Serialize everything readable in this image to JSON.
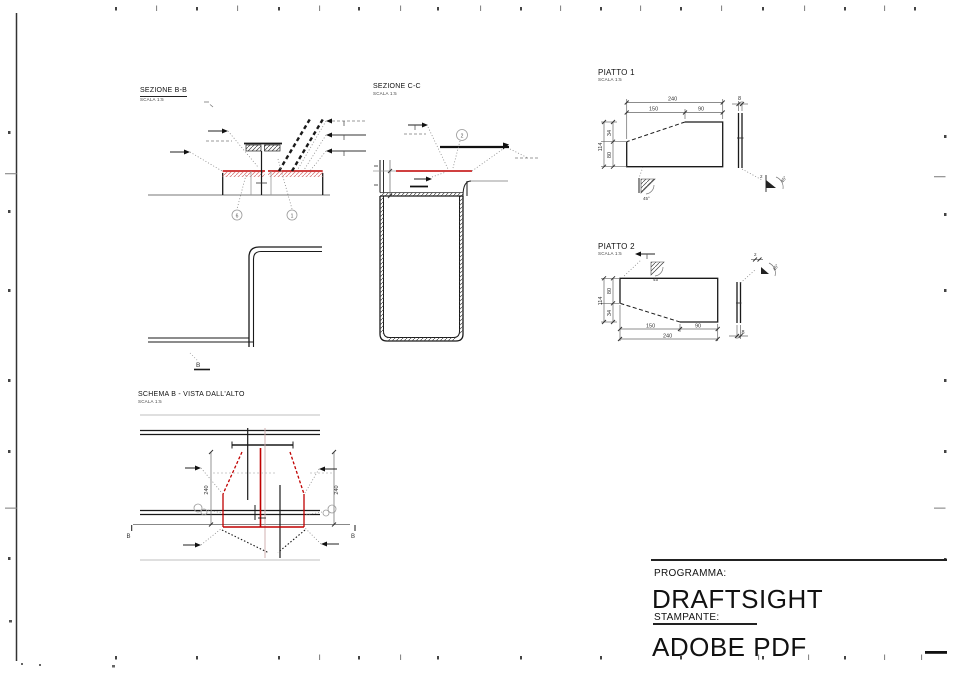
{
  "sheet": {
    "background": "#ffffff",
    "frame_color": "#333333"
  },
  "colors": {
    "red": "#c00000",
    "line": "#1a1a1a",
    "dim": "#555555",
    "construction": "#999999"
  },
  "views": {
    "sezione_bb": {
      "title": "SEZIONE B-B",
      "scale": "SCALA 1:5",
      "balloon_left": "6",
      "balloon_right": "1",
      "section_marker": "B"
    },
    "sezione_cc": {
      "title": "SEZIONE C-C",
      "scale": "SCALA 1:5",
      "balloon": "2"
    },
    "piatto1": {
      "title": "PIATTO 1",
      "scale": "SCALA 1:5",
      "dims": {
        "total": "240",
        "seg_left": "150",
        "seg_right": "90",
        "thickness": "8",
        "height": "114",
        "seg_top": "34",
        "seg_bottom": "80",
        "weld_angle": "45°",
        "weld_size": "2"
      }
    },
    "piatto2": {
      "title": "PIATTO 2",
      "scale": "SCALA 1:5",
      "dims": {
        "total": "240",
        "seg_left": "150",
        "seg_right": "90",
        "thickness": "8",
        "height": "114",
        "seg_top": "80",
        "seg_bottom": "34",
        "weld_angle": "45°",
        "weld_size": "2"
      }
    },
    "schema_b": {
      "title": "SCHEMA B - VISTA DALL'ALTO",
      "scale": "SCALA 1:5",
      "dim_left": "240",
      "dim_right": "240",
      "marker_left": "B",
      "marker_right": "B"
    }
  },
  "title_block": {
    "program_label": "PROGRAMMA:",
    "program_value": "DRAFTSIGHT",
    "printer_label": "STAMPANTE:",
    "printer_value": "ADOBE PDF"
  }
}
